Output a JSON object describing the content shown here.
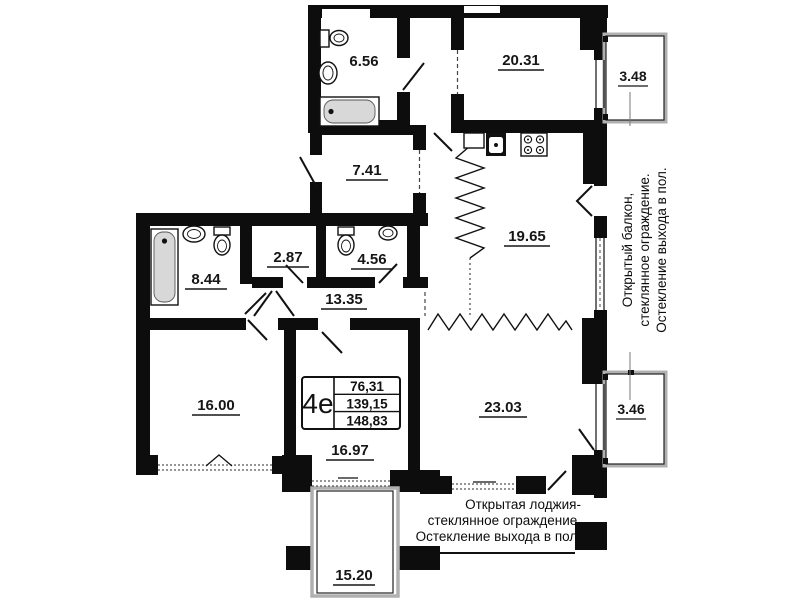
{
  "plan": {
    "unit_box": {
      "type": "4е",
      "rows": [
        "76,31",
        "139,15",
        "148,83"
      ]
    },
    "rooms": {
      "bath_top": "6.56",
      "room_top_right": "20.31",
      "balcony_top": "3.48",
      "room_741": "7.41",
      "kitchen": "19.65",
      "bath_left": "8.44",
      "closet": "2.87",
      "wc": "4.56",
      "corridor": "13.35",
      "room_16": "16.00",
      "room_1697": "16.97",
      "room_23": "23.03",
      "balcony_bottom": "3.46",
      "loggia": "15.20"
    },
    "notes": {
      "right_line1": "Открытый балкон,",
      "right_line2": "стеклянное ограждение.",
      "right_line3": "Остекление выхода в пол.",
      "bottom_line1": "Открытая лоджия-",
      "bottom_line2": "стеклянное ограждение.",
      "bottom_line3": "Остекление выхода в пол."
    },
    "colors": {
      "wall": "#0d0d0d",
      "fixture_fill": "#d8d8d8",
      "rail": "#b0b0b0"
    }
  }
}
